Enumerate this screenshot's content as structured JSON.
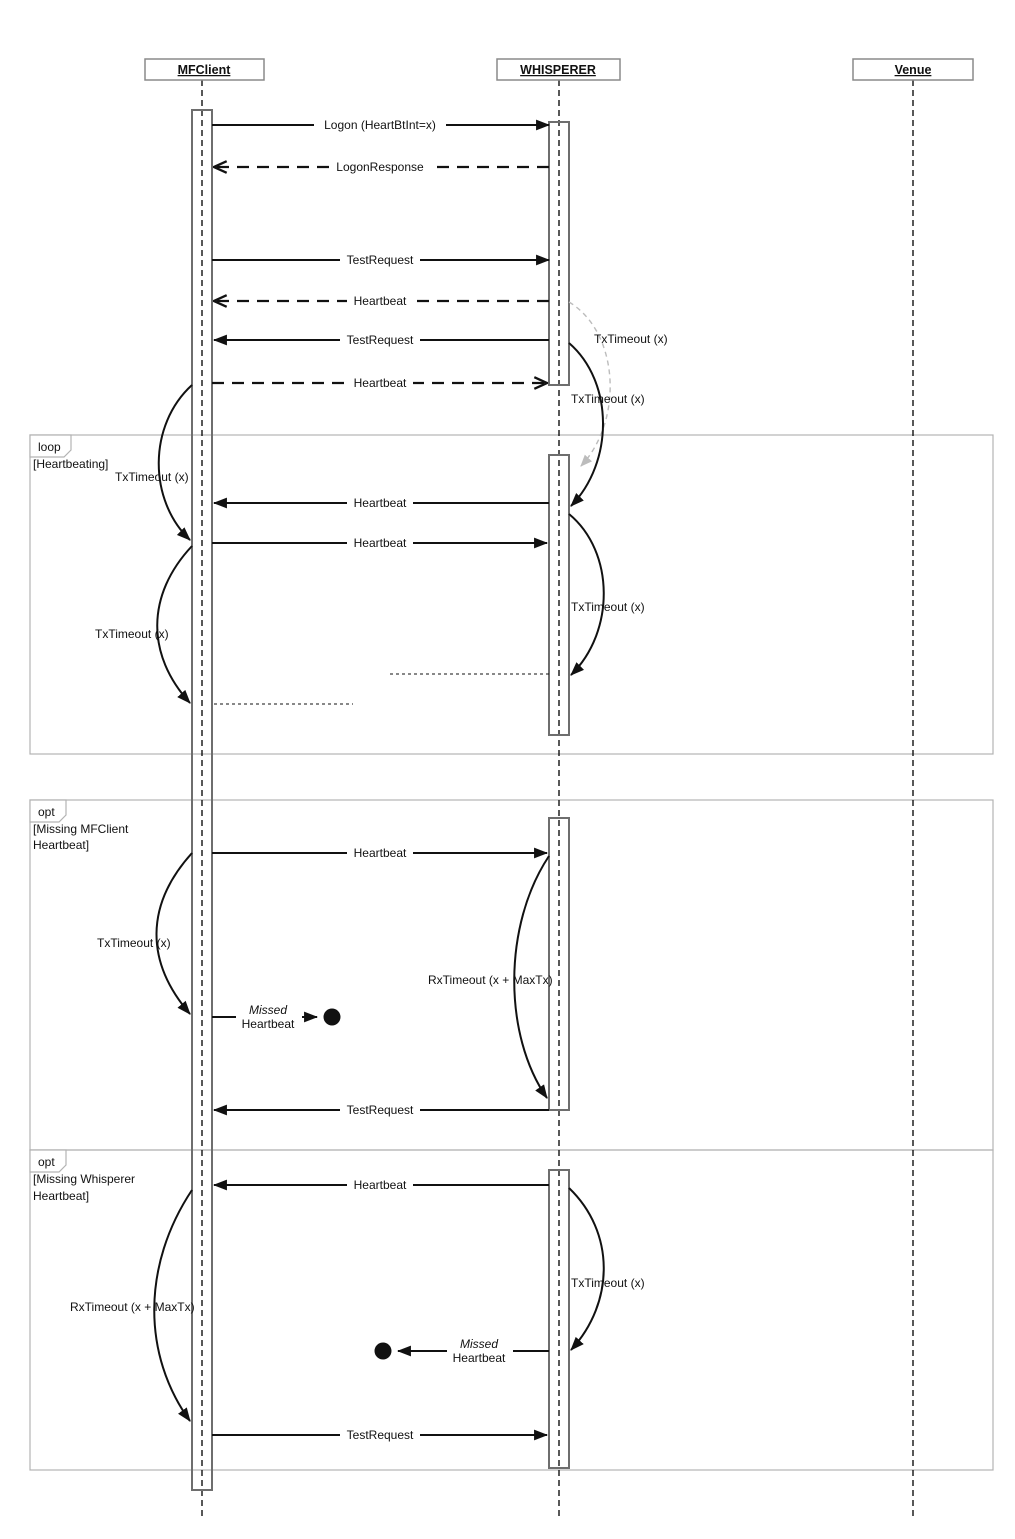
{
  "participants": [
    {
      "name": "MFClient"
    },
    {
      "name": "WHISPERER"
    },
    {
      "name": "Venue"
    }
  ],
  "frames": [
    {
      "operator": "loop",
      "guard_line1": "[Heartbeating]",
      "guard_line2": ""
    },
    {
      "operator": "opt",
      "guard_line1": "[Missing MFClient",
      "guard_line2": "Heartbeat]"
    },
    {
      "operator": "opt",
      "guard_line1": "[Missing Whisperer",
      "guard_line2": "Heartbeat]"
    }
  ],
  "messages": [
    {
      "label": "Logon (HeartBtInt=x)",
      "from": "MFClient",
      "to": "WHISPERER",
      "style": "solid"
    },
    {
      "label": "LogonResponse",
      "from": "WHISPERER",
      "to": "MFClient",
      "style": "dashed"
    },
    {
      "label": "TestRequest",
      "from": "MFClient",
      "to": "WHISPERER",
      "style": "solid"
    },
    {
      "label": "Heartbeat",
      "from": "WHISPERER",
      "to": "MFClient",
      "style": "dashed"
    },
    {
      "label": "TestRequest",
      "from": "WHISPERER",
      "to": "MFClient",
      "style": "solid"
    },
    {
      "label": "Heartbeat",
      "from": "MFClient",
      "to": "WHISPERER",
      "style": "dashed"
    },
    {
      "label": "Heartbeat",
      "from": "WHISPERER",
      "to": "MFClient",
      "style": "solid"
    },
    {
      "label": "Heartbeat",
      "from": "MFClient",
      "to": "WHISPERER",
      "style": "solid"
    },
    {
      "label": "Heartbeat",
      "from": "MFClient",
      "to": "WHISPERER",
      "style": "solid"
    },
    {
      "label": "TestRequest",
      "from": "WHISPERER",
      "to": "MFClient",
      "style": "solid"
    },
    {
      "label": "Heartbeat",
      "from": "WHISPERER",
      "to": "MFClient",
      "style": "solid"
    },
    {
      "label": "TestRequest",
      "from": "MFClient",
      "to": "WHISPERER",
      "style": "solid"
    }
  ],
  "timeouts": [
    {
      "label": "TxTimeout (x)",
      "variant": "gray"
    },
    {
      "label": "TxTimeout (x)",
      "variant": "black"
    },
    {
      "label": "TxTimeout (x)",
      "variant": "black"
    },
    {
      "label": "TxTimeout (x)",
      "variant": "black"
    },
    {
      "label": "TxTimeout (x)",
      "variant": "black"
    },
    {
      "label": "TxTimeout (x)",
      "variant": "black"
    },
    {
      "label": "RxTimeout (x + MaxTx)",
      "variant": "black"
    },
    {
      "label": "TxTimeout (x)",
      "variant": "black"
    },
    {
      "label": "RxTimeout (x + MaxTx)",
      "variant": "black"
    }
  ],
  "lost_messages": [
    {
      "line1": "Missed",
      "line2": "Heartbeat"
    },
    {
      "line1": "Missed",
      "line2": "Heartbeat"
    }
  ],
  "colors": {
    "line": "#111111",
    "frame_border": "#b3b3b3",
    "gray_note": "#b0b0b0",
    "activation_border": "#6e6e6e",
    "background": "#ffffff"
  }
}
